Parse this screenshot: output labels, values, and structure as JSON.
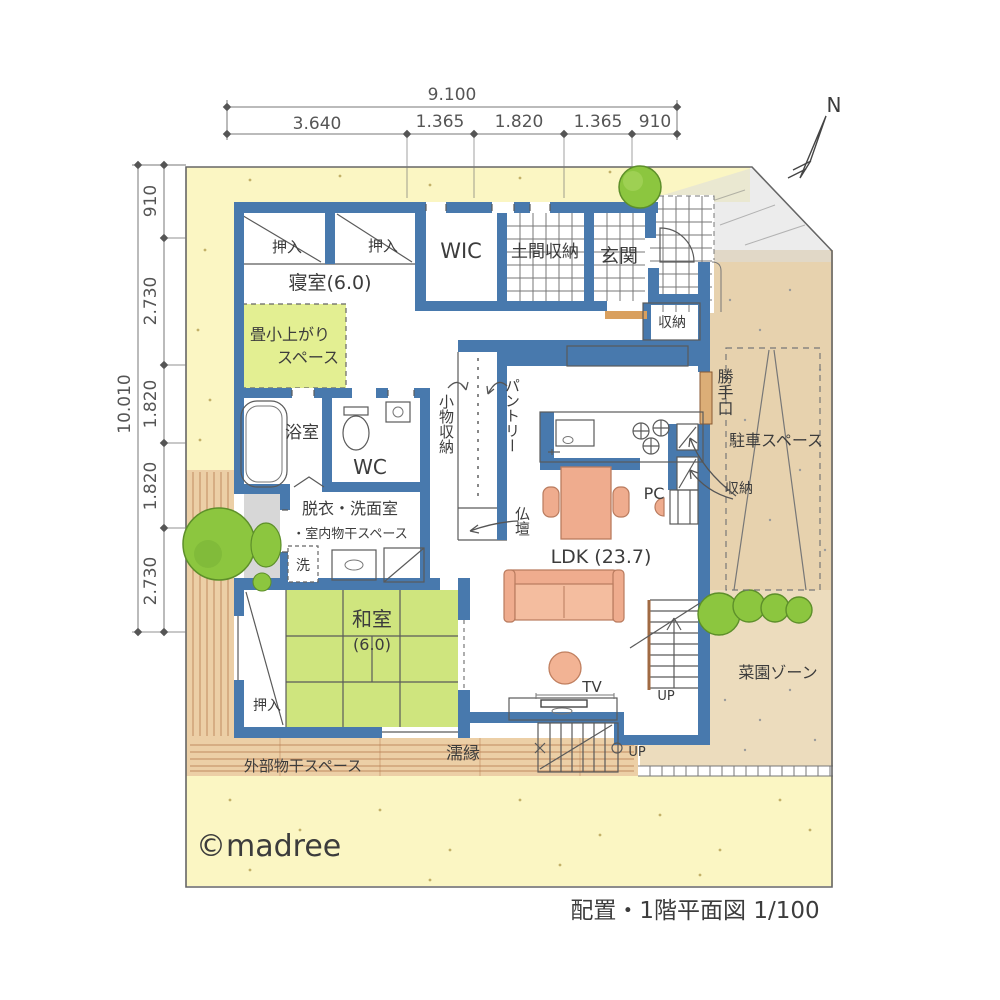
{
  "footer": {
    "watermark": "©madree",
    "title": "配置・1階平面図 1/100"
  },
  "compass": {
    "north": "N"
  },
  "dimensions": {
    "top": {
      "total": "9.100",
      "seg1": "3.640",
      "seg2": "1.365",
      "seg3": "1.820",
      "seg4": "1.365",
      "seg5": "910"
    },
    "left": {
      "total": "10.010",
      "seg1": "910",
      "seg2": "2.730",
      "seg3": "1.820",
      "seg4": "1.820",
      "seg5": "2.730"
    }
  },
  "labels": {
    "closet_a": "押入",
    "closet_b": "押入",
    "closet_washitsu": "押入",
    "wic": "WIC",
    "doma_storage": "土間収納",
    "entrance": "玄関",
    "bedroom": "寝室(6.0)",
    "tatami_step1": "畳小上がり",
    "tatami_step2": "スペース",
    "bath": "浴室",
    "wc": "WC",
    "powder1": "脱衣・洗面室",
    "powder2": "・室内物干スペース",
    "washer": "洗",
    "washitsu1": "和室",
    "washitsu2": "(6.0)",
    "komono_storage": "小物収納",
    "pantry": "パントリー",
    "butsudan": "仏壇",
    "hall_storage": "収納",
    "kitchen_storage": "収納",
    "back_door": "勝手口",
    "parking": "駐車スペース",
    "pc": "PC",
    "ldk": "LDK (23.7)",
    "tv": "TV",
    "stairs_up": "UP",
    "garden_steps_up": "UP",
    "nureen": "濡縁",
    "outdoor_drying": "外部物干スペース",
    "garden_zone": "菜園ゾーン"
  },
  "colors": {
    "wall": "#4879ad",
    "tatami": "#cfe57e",
    "tatami_step": "#e3ef92",
    "lawn": "#fbf6c3",
    "ground": "#e7d2ae",
    "wood": "#eccfa6",
    "water": "#a9dbe9",
    "furniture": "#efac8e",
    "tree": "#8cc63f"
  }
}
